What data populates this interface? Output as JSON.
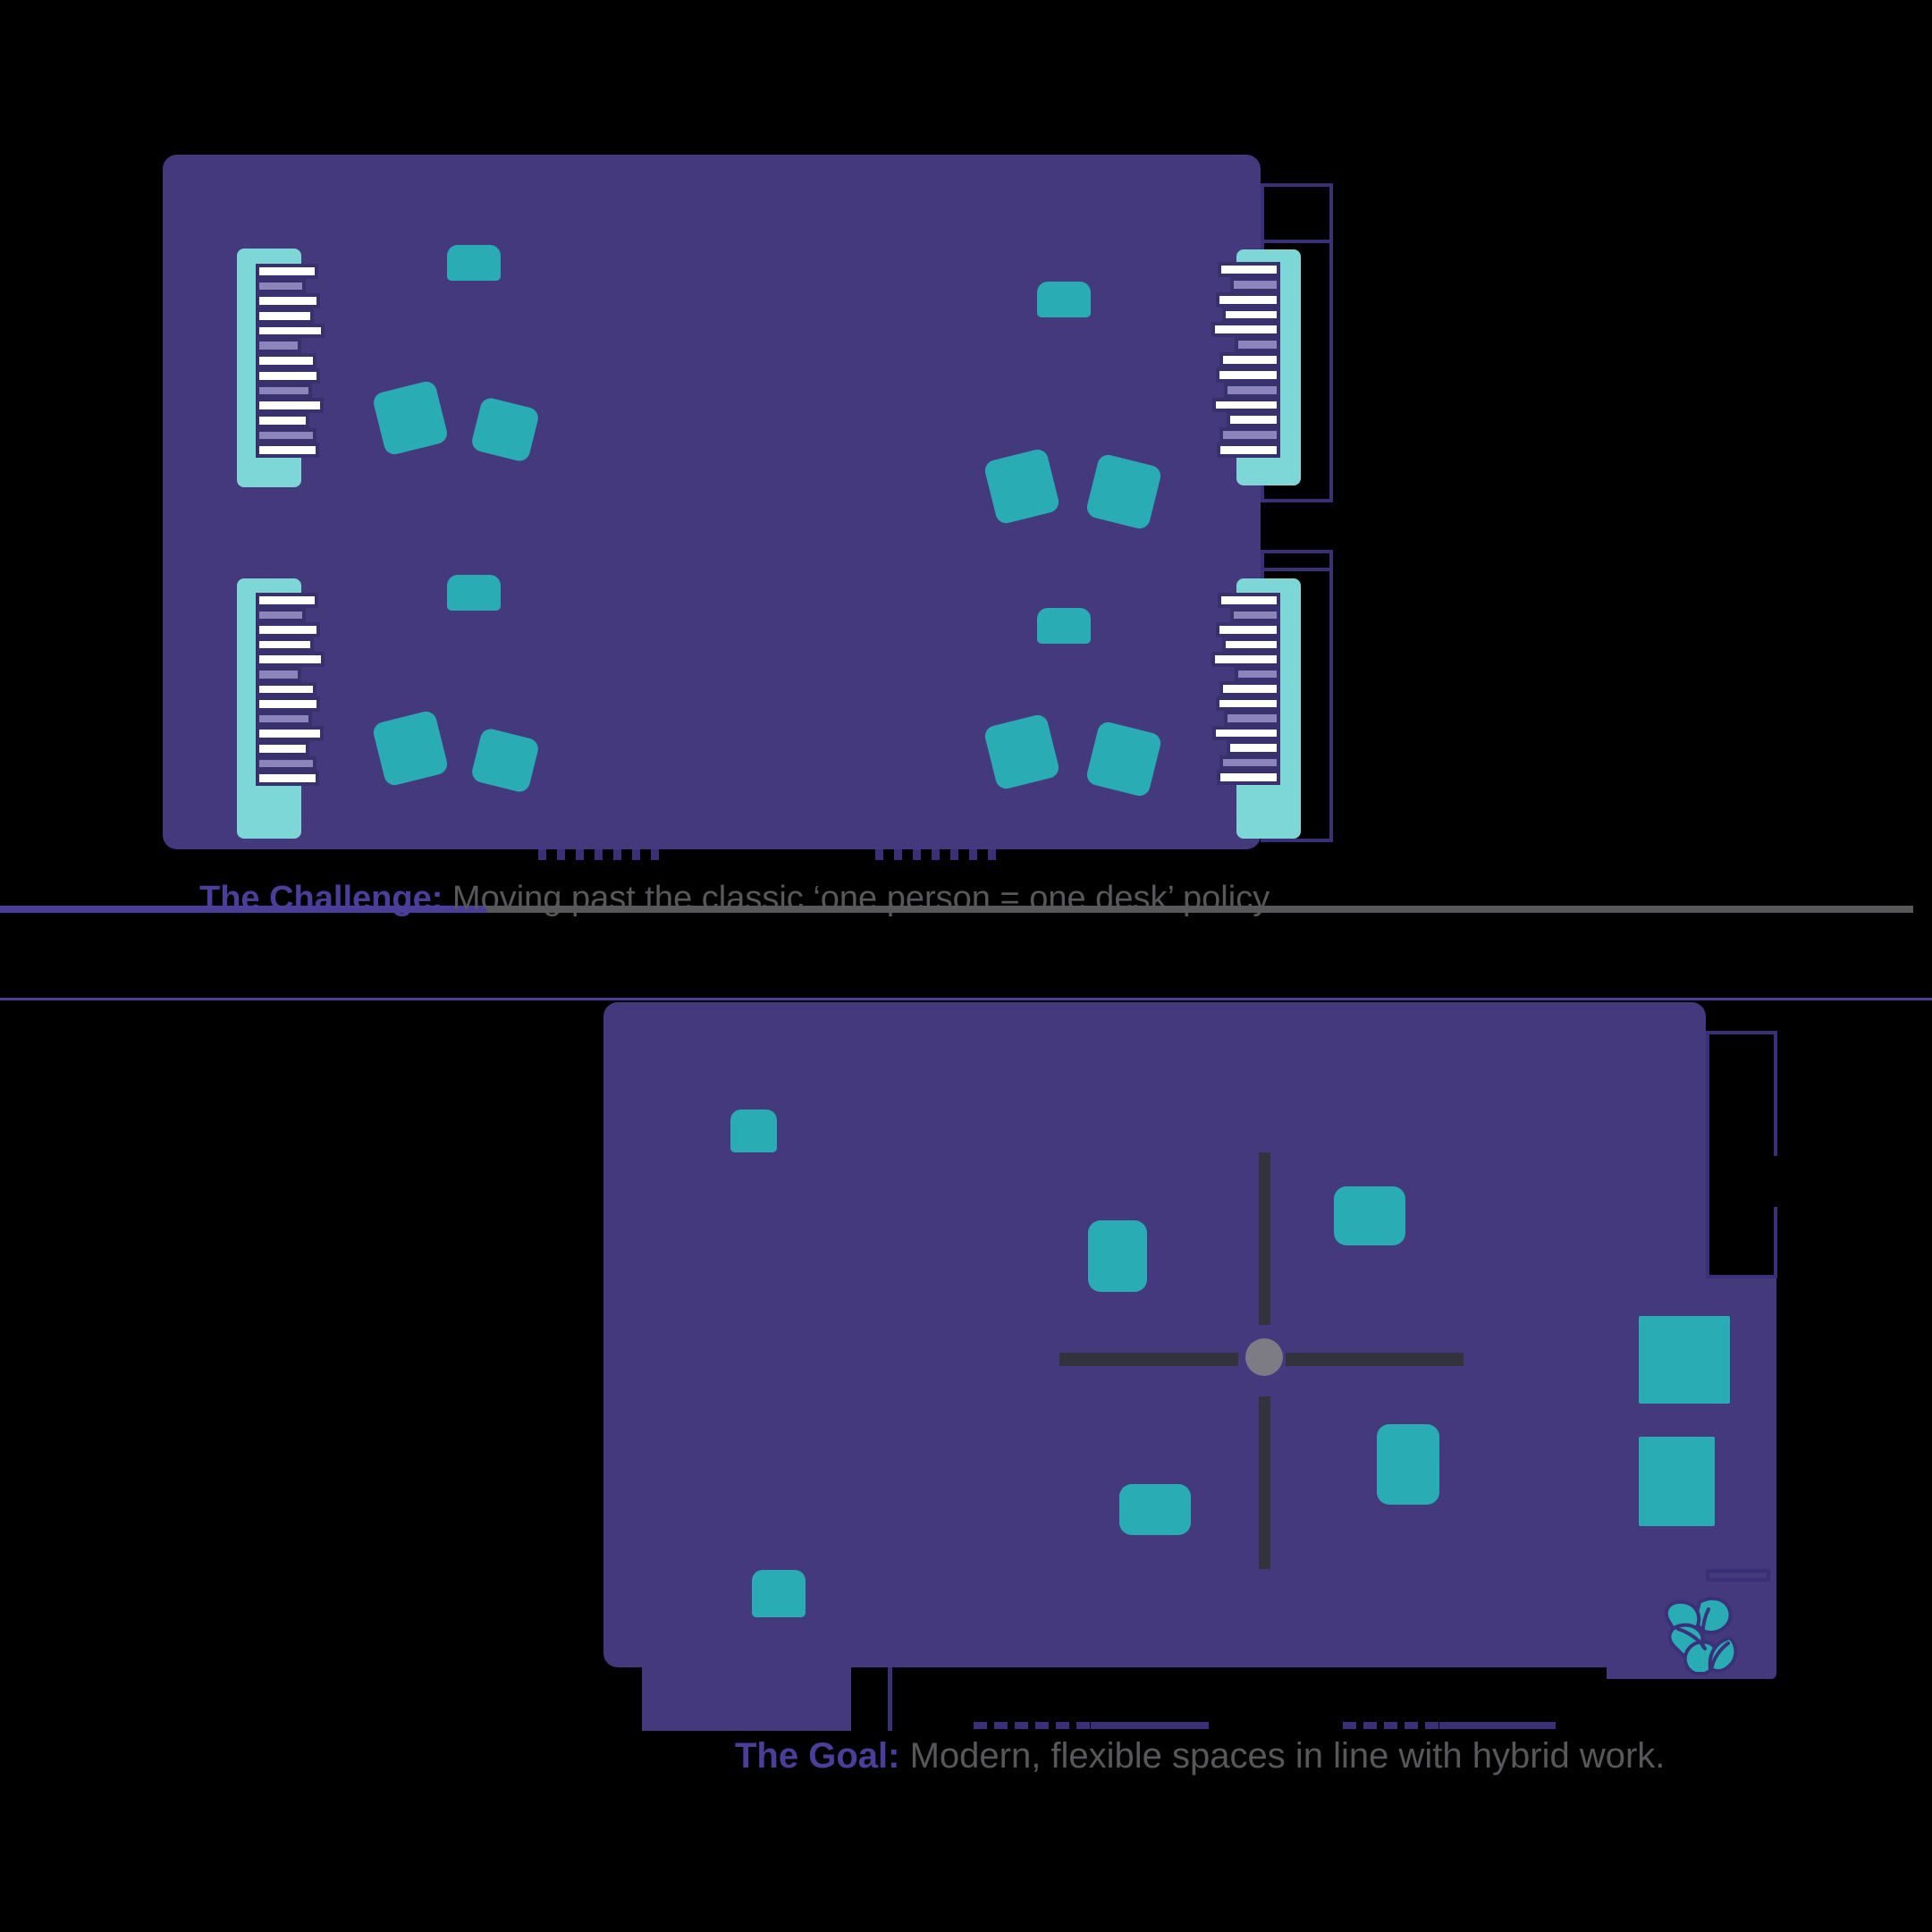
{
  "captions": {
    "challenge": {
      "prefix": "The Challenge:",
      "text": " Moving past the classic ‘one person = one desk’ policy"
    },
    "goal": {
      "prefix": "The Goal:",
      "text": "  Modern, flexible spaces in line with hybrid work."
    }
  },
  "icons": {
    "logo": "trillium-flower-logo"
  },
  "colors": {
    "purple": "#45397E",
    "outline": "#3A3078",
    "mint": "#7CD7D6",
    "teal": "#2AACB5",
    "lavender": "#8C85BB",
    "navy": "#39306E",
    "caption_purple": "#4A3E99",
    "caption_gray": "#58585B",
    "cross": "#33333E",
    "dot": "#7D7B84"
  },
  "shelf": {
    "bars": [
      {
        "w": 100,
        "c": "w"
      },
      {
        "w": 78,
        "c": "l"
      },
      {
        "w": 104,
        "c": "w"
      },
      {
        "w": 92,
        "c": "w"
      },
      {
        "w": 112,
        "c": "w"
      },
      {
        "w": 70,
        "c": "l"
      },
      {
        "w": 96,
        "c": "w"
      },
      {
        "w": 104,
        "c": "w"
      },
      {
        "w": 88,
        "c": "l"
      },
      {
        "w": 110,
        "c": "w"
      },
      {
        "w": 84,
        "c": "w"
      },
      {
        "w": 96,
        "c": "l"
      },
      {
        "w": 102,
        "c": "w"
      }
    ]
  }
}
